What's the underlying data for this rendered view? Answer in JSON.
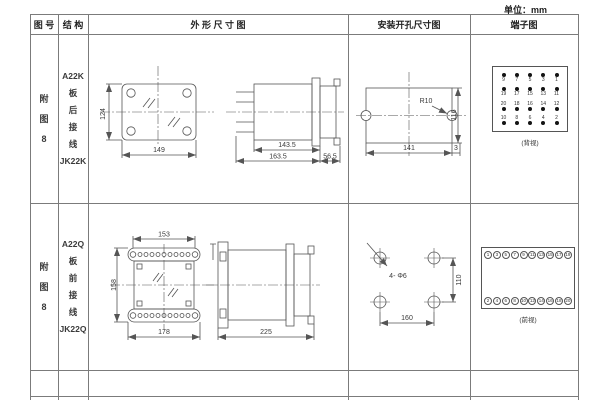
{
  "page": {
    "unit_label": "单位：mm"
  },
  "header": {
    "figure_no": "图 号",
    "structure": "结 构",
    "outline": "外 形 尺 寸 图",
    "mounting": "安装开孔尺寸图",
    "terminal": "端子图"
  },
  "rows": [
    {
      "figure_no": [
        "附",
        "图",
        "8"
      ],
      "structure": [
        "A22K",
        "板",
        "后",
        "接",
        "线",
        "JK22K"
      ],
      "outline": {
        "front_height": "124",
        "front_width": "149",
        "side_len1": "143.5",
        "side_len2": "163.5",
        "side_len3": "56.5"
      },
      "mounting": {
        "radius_label": "R10",
        "width": "141",
        "height": "116",
        "offset": "3"
      },
      "terminal": {
        "view_label": "(背视)",
        "grid": [
          [
            "9",
            "7",
            "5",
            "3",
            "1"
          ],
          [
            "19",
            "17",
            "15",
            "13",
            "11"
          ],
          [
            "20",
            "18",
            "16",
            "14",
            "12"
          ],
          [
            "10",
            "8",
            "6",
            "4",
            "2"
          ]
        ]
      }
    },
    {
      "figure_no": [
        "附",
        "图",
        "8"
      ],
      "structure": [
        "A22Q",
        "板",
        "前",
        "接",
        "线",
        "JK22Q"
      ],
      "outline": {
        "front_top_width": "153",
        "front_height": "158",
        "front_bottom_width": "178",
        "side_length": "225"
      },
      "mounting": {
        "hole_label": "4- Φ6",
        "width": "160",
        "height": "110"
      },
      "terminal": {
        "view_label": "(前视)",
        "top_numbers": [
          "1",
          "3",
          "5",
          "7",
          "9",
          "11",
          "13",
          "15",
          "17",
          "19"
        ],
        "bottom_numbers": [
          "2",
          "4",
          "6",
          "8",
          "10",
          "12",
          "14",
          "16",
          "18",
          "20"
        ]
      }
    }
  ]
}
